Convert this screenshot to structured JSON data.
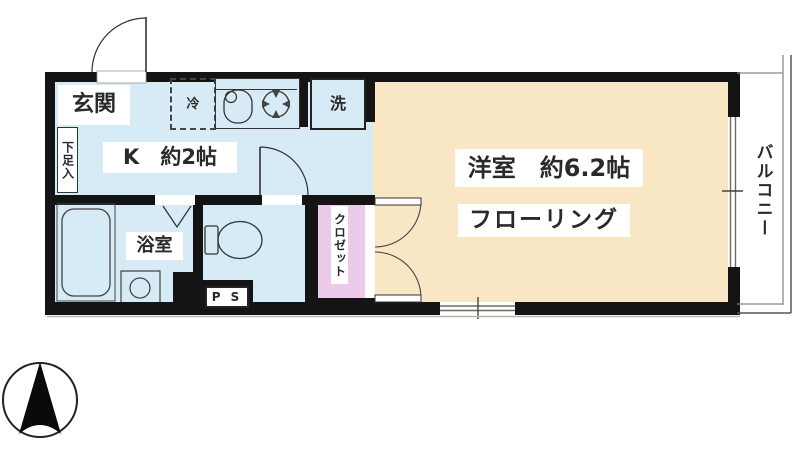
{
  "floorplan": {
    "labels": {
      "entrance": "玄関",
      "shoe_cabinet": "下足入",
      "refrigerator": "冷",
      "kitchen": "K　約2帖",
      "washer": "洗",
      "bathroom": "浴室",
      "western_room": "洋室　約6.2帖",
      "flooring": "フローリング",
      "closet": "クロゼット",
      "pipe_space": "P S",
      "balcony": "バルコニー"
    },
    "colors": {
      "kitchen_floor": "#d6ebf5",
      "western_room_floor": "#f9e6c4",
      "closet_fill": "#eccaea",
      "wall": "#141414",
      "line": "#444444"
    },
    "icons": {
      "north_arrow": "compass-north-arrow",
      "toilet": "toilet-bowl",
      "bathtub": "bathtub",
      "kitchen_sink": "sink-with-faucet",
      "stove": "burner-circle",
      "washbasin": "round-basin",
      "doors": "swing-and-folding-door-arcs",
      "windows": "double-line-sliding-windows"
    }
  }
}
